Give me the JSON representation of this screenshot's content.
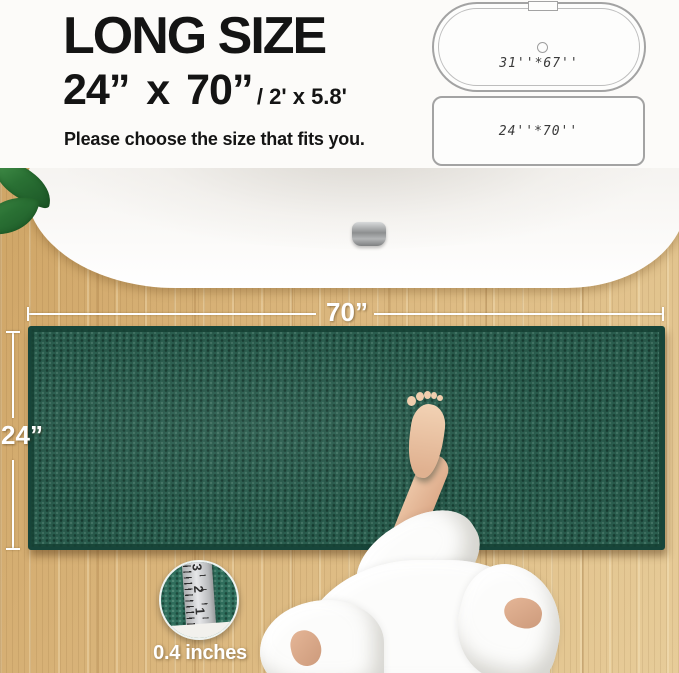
{
  "header": {
    "title": "LONG SIZE",
    "size_main": "24”  x 70”",
    "size_alt": "/ 2' x 5.8'",
    "subtitle": "Please choose the size that fits you.",
    "tub_label": "31''*67''",
    "mat_label": "24''*70''"
  },
  "photo": {
    "width_label": "70”",
    "height_label": "24”",
    "inset_caption": "0.4 inches",
    "ruler_numbers": [
      "3",
      "2",
      "1"
    ]
  },
  "colors": {
    "rug": "#2a5d4e",
    "rug_border": "#17453a",
    "wood": "#d8b279",
    "leaf": "#2a7134",
    "headline_text": "#141414",
    "dimension_line": "#ffffff"
  }
}
